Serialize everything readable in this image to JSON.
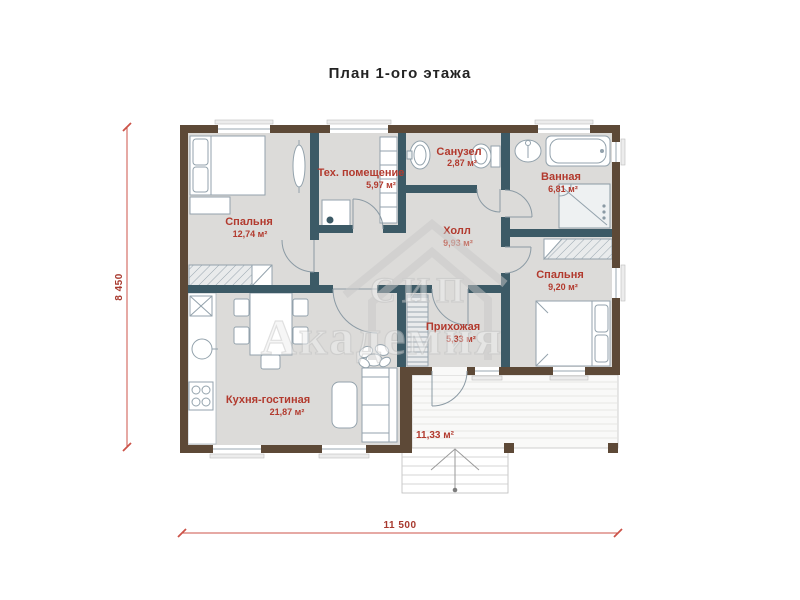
{
  "title": "План 1-ого этажа",
  "rooms": {
    "bedroom1": {
      "name": "Спальня",
      "area": "12,74 м²"
    },
    "tech": {
      "name": "Тех. помещение",
      "area": "5,97 м²"
    },
    "wc": {
      "name": "Санузел",
      "area": "2,87 м²"
    },
    "bath": {
      "name": "Ванная",
      "area": "6,81 м²"
    },
    "hall": {
      "name": "Холл",
      "area": "9,93 м²"
    },
    "bedroom2": {
      "name": "Спальня",
      "area": "9,20 м²"
    },
    "entry": {
      "name": "Прихожая",
      "area": "5,33 м²"
    },
    "kitchen": {
      "name": "Кухня-гостиная",
      "area": "21,87 м²"
    },
    "terrace": {
      "area": "11,33 м²"
    }
  },
  "dimensions": {
    "width": "11 500",
    "height": "8 450"
  },
  "watermark": {
    "line1": "СИП",
    "line2": "Академия"
  },
  "colors": {
    "exterior_wall": "#5d4937",
    "interior_wall": "#3c5a66",
    "floor": "#dcdbd9",
    "room_label": "#b23a2e",
    "dimension": "#cc5348",
    "watermark": "#c9c9c9",
    "background": "#ffffff"
  }
}
